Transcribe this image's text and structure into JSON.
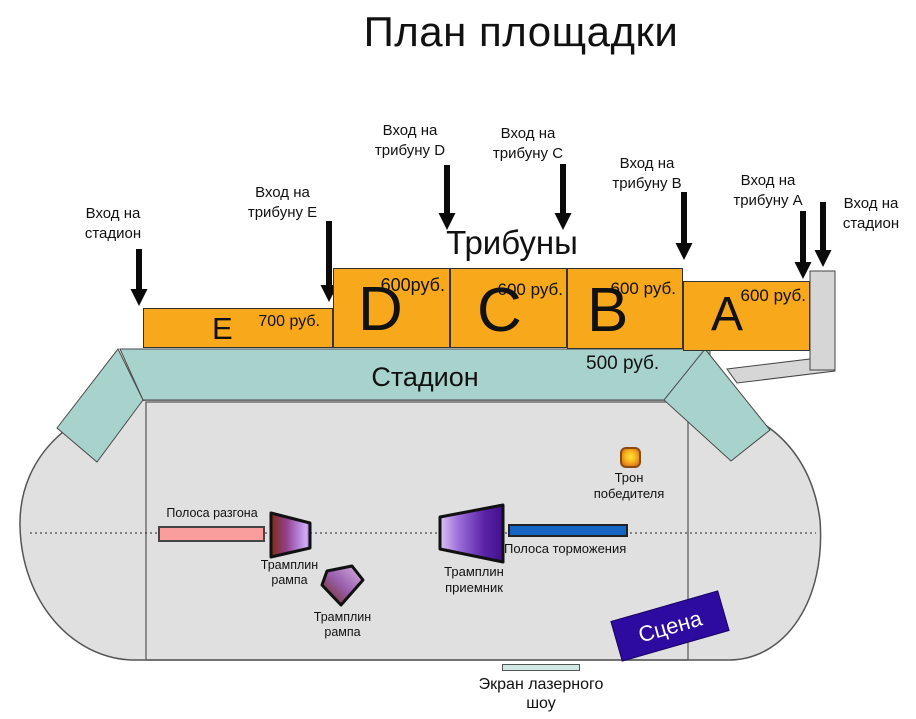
{
  "title": "План площадки",
  "colors": {
    "orange": "#F7A81B",
    "teal": "#A8D3CC",
    "field-gray": "#E0E0E0",
    "walkway-gray": "#D6D6D6",
    "pink": "#FA9D9D",
    "blue": "#1565C4",
    "stage-purple": "#2E0BA0",
    "screen-teal": "#CFE8E4"
  },
  "entrances": [
    {
      "line1": "Вход на",
      "line2": "стадион"
    },
    {
      "line1": "Вход на",
      "line2": "трибуну E"
    },
    {
      "line1": "Вход на",
      "line2": "трибуну D"
    },
    {
      "line1": "Вход на",
      "line2": "трибуну C"
    },
    {
      "line1": "Вход на",
      "line2": "трибуну B"
    },
    {
      "line1": "Вход на",
      "line2": "трибуну A"
    },
    {
      "line1": "Вход на",
      "line2": "стадион"
    }
  ],
  "tribunes_heading": "Трибуны",
  "tribunes": [
    {
      "letter": "E",
      "price": "700 руб."
    },
    {
      "letter": "D",
      "price": "600руб."
    },
    {
      "letter": "C",
      "price": "600 руб."
    },
    {
      "letter": "B",
      "price": "600 руб."
    },
    {
      "letter": "A",
      "price": "600 руб."
    }
  ],
  "stadium": {
    "label": "Стадион",
    "standing_price": "500 руб."
  },
  "field": {
    "run_strip": "Полоса разгона",
    "ramp1_line1": "Трамплин",
    "ramp1_line2": "рампа",
    "ramp2_line1": "Трамплин",
    "ramp2_line2": "рампа",
    "receiver_line1": "Трамплин",
    "receiver_line2": "приемник",
    "brake_strip": "Полоса торможения",
    "throne_line1": "Трон",
    "throne_line2": "победителя",
    "stage": "Сцена",
    "screen_line1": "Экран лазерного",
    "screen_line2": "шоу"
  }
}
